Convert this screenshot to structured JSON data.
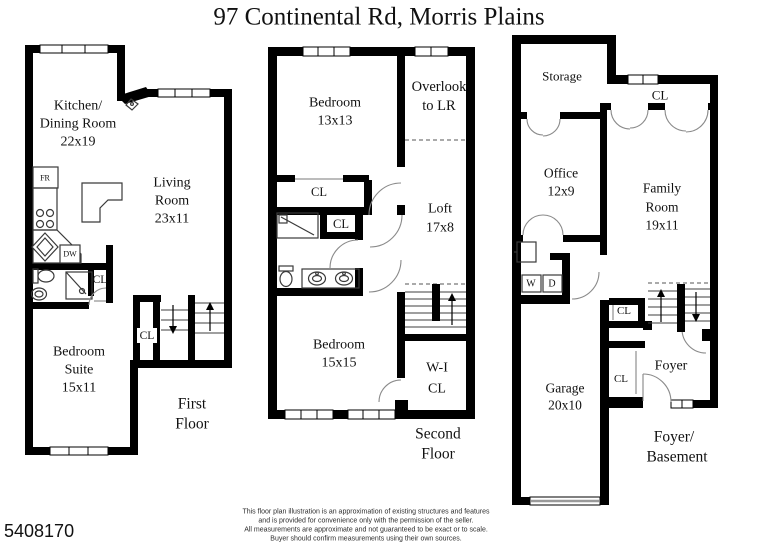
{
  "title": "97 Continental Rd, Morris Plains",
  "listing_id": "5408170",
  "colors": {
    "wall": "#000000",
    "background": "#ffffff",
    "door_arc": "#8a8a8a"
  },
  "first_floor": {
    "floor_label": [
      "First",
      "Floor"
    ],
    "kitchen": [
      "Kitchen/",
      "Dining Room",
      "22x19"
    ],
    "living_room": [
      "Living",
      "Room",
      "23x11"
    ],
    "bedroom_suite": [
      "Bedroom",
      "Suite",
      "15x11"
    ],
    "fridge": "FR",
    "dishwasher": "DW",
    "bath_closet": "CL",
    "stair_closet": "CL"
  },
  "second_floor": {
    "floor_label": [
      "Second",
      "Floor"
    ],
    "bedroom_front": [
      "Bedroom",
      "13x13"
    ],
    "overlook": [
      "Overlook",
      "to LR"
    ],
    "closet_a": "CL",
    "closet_b": "CL",
    "loft": [
      "Loft",
      "17x8"
    ],
    "bedroom_back": [
      "Bedroom",
      "15x15"
    ],
    "walk_in_closet": [
      "W-I",
      "CL"
    ],
    "floor_label_note": ""
  },
  "basement": {
    "floor_label": [
      "Foyer/",
      "Basement"
    ],
    "storage": "Storage",
    "family_closet": "CL",
    "office": [
      "Office",
      "12x9"
    ],
    "family_room": [
      "Family",
      "Room",
      "19x11"
    ],
    "washer": "W",
    "dryer": "D",
    "closet_upper": "CL",
    "foyer": "Foyer",
    "closet_lower": "CL",
    "garage": [
      "Garage",
      "20x10"
    ]
  },
  "disclaimer": [
    "This floor plan illustration is an approximation of existing structures and features",
    "and is provided for convenience only with the permission of the seller.",
    "All measurements are approximate and not guaranteed to be exact or to scale.",
    "Buyer should confirm measurements using their own sources."
  ]
}
